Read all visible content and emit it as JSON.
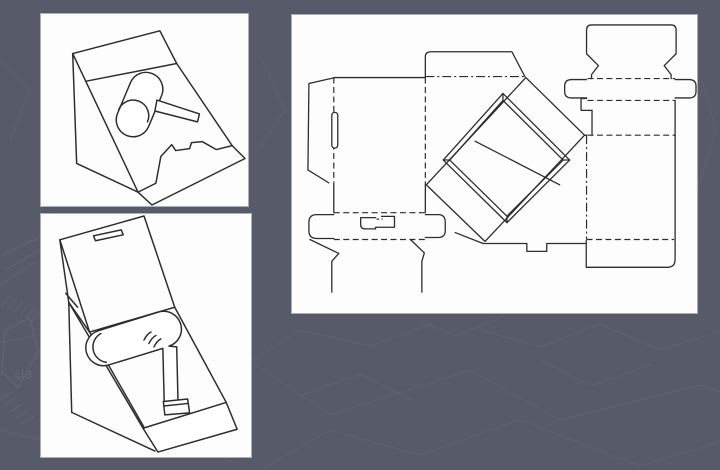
{
  "slide": {
    "watermark_text": "sla",
    "panels": [
      {
        "id": "closed-display",
        "label": "Sketch of closed wedge-shaped counter display box with a hair dryer shown on the sloped face and a thumb notch at the front"
      },
      {
        "id": "open-display",
        "label": "Sketch of opened display box with lid raised upright and hair dryer resting on a support inside the wedge base"
      },
      {
        "id": "dieline",
        "label": "Flat die-cut template of the display box: solid cut lines, dashed fold lines, glue flap, lock slit, display window frame and tuck flaps"
      }
    ]
  },
  "theme": {
    "bg_color": "#575b69",
    "pattern_color": "#9aa0b4",
    "panel_bg": "#fdfdfd",
    "panel_border": "#aab0bb",
    "ink": "#2d2d2d"
  }
}
